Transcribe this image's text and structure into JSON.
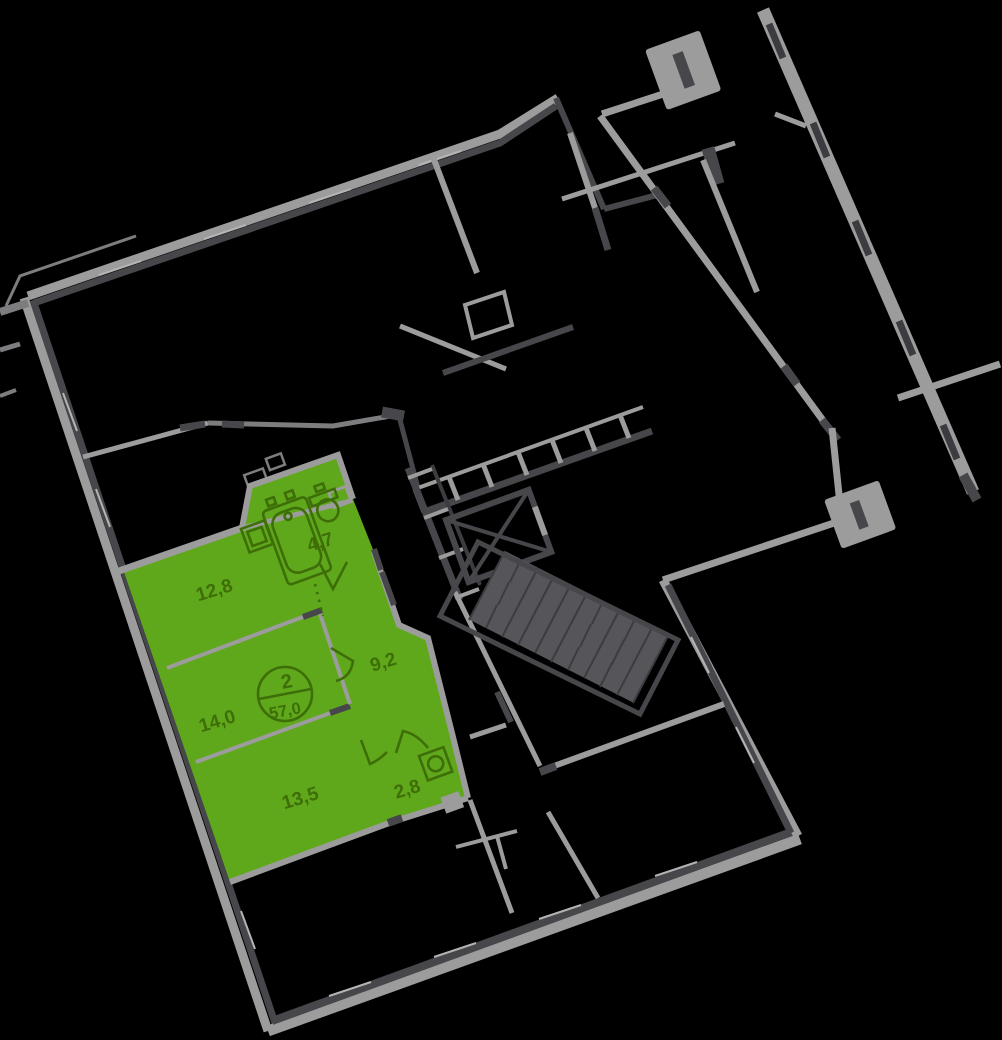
{
  "apartment": {
    "number": "2",
    "total_area": "57,0",
    "rooms": [
      {
        "name": "living-room",
        "label": "12,8"
      },
      {
        "name": "bedroom",
        "label": "14,0"
      },
      {
        "name": "room",
        "label": "13,5"
      },
      {
        "name": "bathroom",
        "label": "4,7"
      },
      {
        "name": "hallway",
        "label": "9,2"
      },
      {
        "name": "wc",
        "label": "2,8"
      }
    ]
  },
  "colors": {
    "background": "#000000",
    "apartment_fill": "#5FA81C",
    "apartment_line": "#3E6E08",
    "wall_light": "#9C9C9C",
    "wall_mid": "#7D7D80",
    "wall_dark": "#47474B",
    "wall_darker": "#3C3C40",
    "window_glass": "#B4B4B4"
  }
}
